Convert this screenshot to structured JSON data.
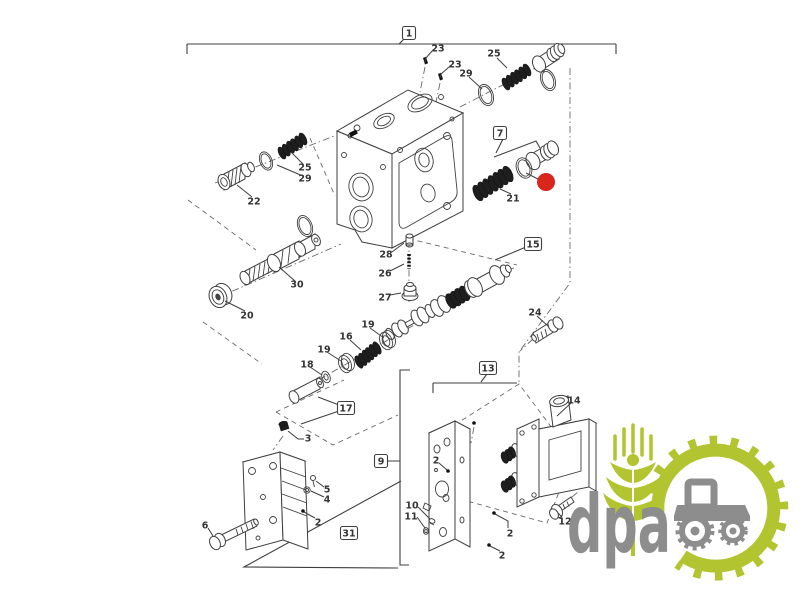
{
  "diagram": {
    "description": "Exploded parts diagram of hydraulic remote control valve assembly",
    "section_labels": [
      {
        "text": "1",
        "x": 409,
        "y": 33
      },
      {
        "text": "7",
        "x": 500,
        "y": 133
      },
      {
        "text": "15",
        "x": 533,
        "y": 244
      },
      {
        "text": "13",
        "x": 488,
        "y": 368
      },
      {
        "text": "17",
        "x": 346,
        "y": 408
      },
      {
        "text": "9",
        "x": 381,
        "y": 461
      },
      {
        "text": "31",
        "x": 349,
        "y": 533
      }
    ],
    "part_labels": [
      {
        "text": "23",
        "x": 438,
        "y": 48
      },
      {
        "text": "23",
        "x": 455,
        "y": 64
      },
      {
        "text": "29",
        "x": 466,
        "y": 73
      },
      {
        "text": "25",
        "x": 494,
        "y": 53
      },
      {
        "text": "25",
        "x": 305,
        "y": 167
      },
      {
        "text": "29",
        "x": 305,
        "y": 178
      },
      {
        "text": "22",
        "x": 254,
        "y": 201
      },
      {
        "text": "21",
        "x": 513,
        "y": 198
      },
      {
        "text": "20",
        "x": 247,
        "y": 315
      },
      {
        "text": "30",
        "x": 297,
        "y": 284
      },
      {
        "text": "28",
        "x": 386,
        "y": 254
      },
      {
        "text": "26",
        "x": 385,
        "y": 273
      },
      {
        "text": "27",
        "x": 385,
        "y": 297
      },
      {
        "text": "24",
        "x": 535,
        "y": 312
      },
      {
        "text": "19",
        "x": 368,
        "y": 324
      },
      {
        "text": "16",
        "x": 346,
        "y": 336
      },
      {
        "text": "19",
        "x": 324,
        "y": 349
      },
      {
        "text": "18",
        "x": 307,
        "y": 364
      },
      {
        "text": "3",
        "x": 308,
        "y": 438
      },
      {
        "text": "5",
        "x": 327,
        "y": 489
      },
      {
        "text": "4",
        "x": 327,
        "y": 499
      },
      {
        "text": "2",
        "x": 318,
        "y": 522
      },
      {
        "text": "6",
        "x": 205,
        "y": 525
      },
      {
        "text": "14",
        "x": 574,
        "y": 400
      },
      {
        "text": "2",
        "x": 436,
        "y": 460
      },
      {
        "text": "10",
        "x": 412,
        "y": 505
      },
      {
        "text": "11",
        "x": 411,
        "y": 516
      },
      {
        "text": "2",
        "x": 510,
        "y": 533
      },
      {
        "text": "2",
        "x": 502,
        "y": 555
      },
      {
        "text": "12",
        "x": 565,
        "y": 521
      }
    ]
  },
  "highlight": {
    "color": "#d9251c",
    "cx": 546,
    "cy": 182,
    "r": 9
  },
  "watermark": {
    "text": "dpa"
  },
  "colors": {
    "line": "#3f3f3f",
    "construction": "#6a6a6a",
    "label": "#333333",
    "brand-green": "#b2c42f",
    "brand-gray": "#8d8d8d",
    "highlight-red": "#d9251c",
    "background": "#ffffff"
  }
}
